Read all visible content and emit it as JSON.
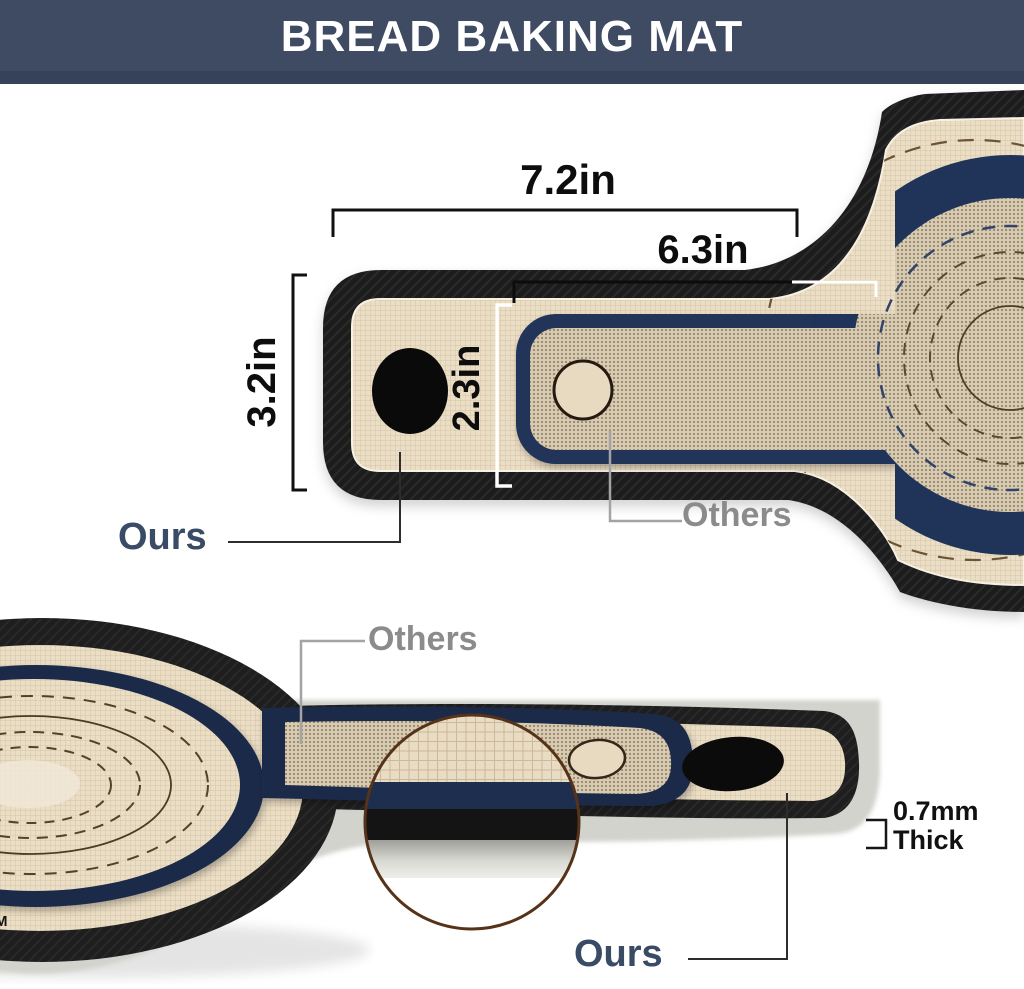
{
  "header": {
    "title": "BREAD BAKING MAT"
  },
  "top_view": {
    "dim_total_length": "7.2in",
    "dim_others_length": "6.3in",
    "dim_ours_width": "3.2in",
    "dim_others_width": "2.3in",
    "label_ours": "Ours",
    "label_others": "Others"
  },
  "side_view": {
    "label_ours": "Ours",
    "label_others": "Others",
    "thickness_value": "0.7mm",
    "thickness_unit_word": "Thick",
    "watermark": "M"
  },
  "colors": {
    "header_bg": "#3e4b62",
    "header_text": "#ffffff",
    "mat_black": "#1e1e1e",
    "mat_tan": "#ebdec6",
    "mat_tan_dense": "#d8cab0",
    "mat_navy": "#203459",
    "ours_label_color": "#3a4b66",
    "others_label_color": "#8b8b8b",
    "guide_line_brown": "#6b5335",
    "magnifier_ring": "#553218",
    "underside_silver": "#d3d3cd"
  }
}
